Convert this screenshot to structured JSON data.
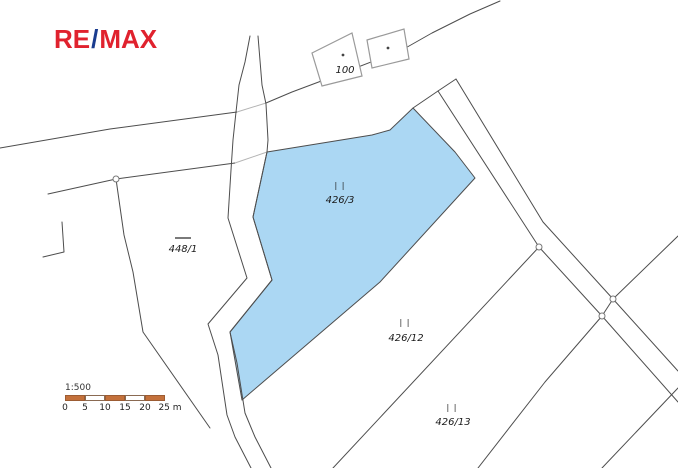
{
  "logo": {
    "re": "RE",
    "slash": "/",
    "max": "MAX",
    "color_red": "#e0222e",
    "color_blue": "#1a3c8f"
  },
  "map": {
    "type": "cadastral-parcel-map",
    "highlight_color": "#abd7f3",
    "line_color": "#4d4d4d",
    "parcels": [
      {
        "id": "426/3",
        "land_use_symbol": "| |",
        "highlighted": true
      },
      {
        "id": "426/12",
        "land_use_symbol": "| |",
        "highlighted": false
      },
      {
        "id": "426/13",
        "land_use_symbol": "| |",
        "highlighted": false
      },
      {
        "id": "448/1",
        "land_use_symbol": "—",
        "highlighted": false
      },
      {
        "id": "100",
        "land_use_symbol": "",
        "highlighted": false,
        "kind": "building"
      }
    ]
  },
  "scale_bar": {
    "ratio_label": "1:500",
    "tick_labels": [
      "0",
      "5",
      "10",
      "15",
      "20",
      "25 m"
    ],
    "bar_color": "#c4713b"
  }
}
